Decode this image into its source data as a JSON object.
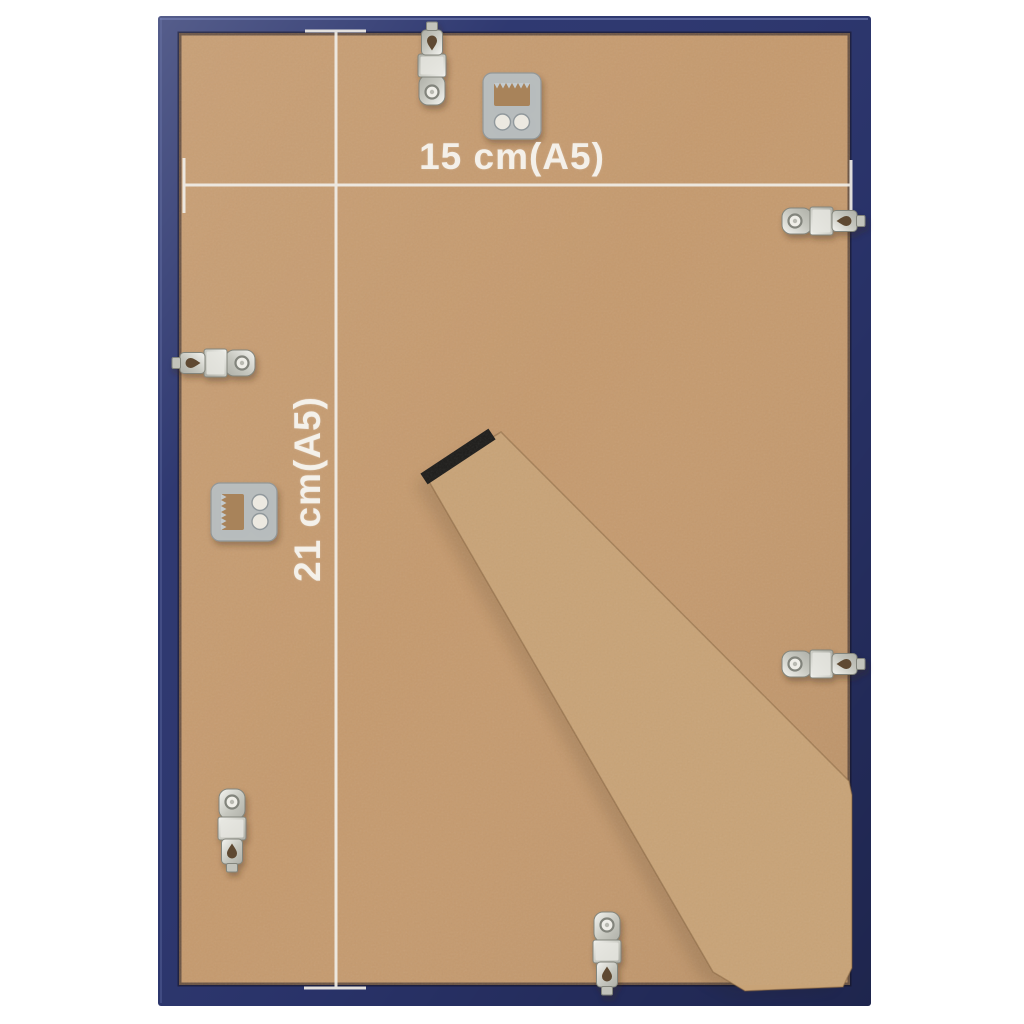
{
  "page": {
    "background": "#ffffff"
  },
  "measurements": {
    "width_label": "15 cm(A5)",
    "height_label": "21 cm(A5)"
  },
  "colors": {
    "frame_blue": "#2b356e",
    "frame_blue_dark": "#1e2650",
    "frame_highlight": "#7b87bd",
    "board_tan": "#c59a6e",
    "stand_tan": "#c8a377",
    "hinge_black": "#1d1c1a",
    "metal_silver": "#cfd0ca",
    "hanger_grey": "#b9c0c4",
    "line_white": "#f1eee8"
  },
  "hardware": {
    "clips": [
      "top",
      "left",
      "bottom-left",
      "bottom-center",
      "top-right",
      "middle-right"
    ],
    "hangers": [
      "top",
      "left"
    ]
  }
}
